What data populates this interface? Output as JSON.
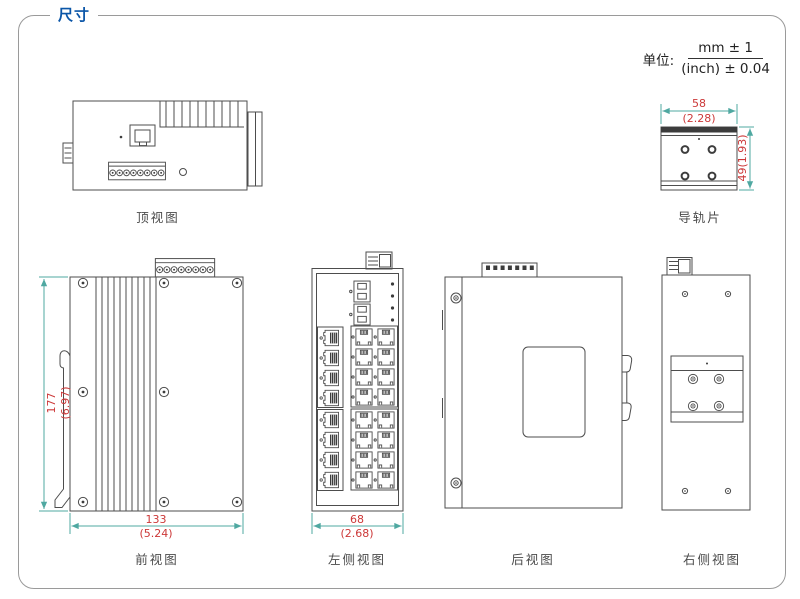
{
  "header": {
    "title": "尺寸"
  },
  "unit": {
    "label": "单位:",
    "numerator": "mm ± 1",
    "denominator": "(inch) ± 0.04"
  },
  "views": {
    "top": {
      "label": "顶视图"
    },
    "rail": {
      "label": "导轨片",
      "width_mm": "58",
      "width_inch": "(2.28)",
      "height_dim": "49(1.93)"
    },
    "front": {
      "label": "前视图",
      "height_mm": "177",
      "height_inch": "(6.97)",
      "width_mm": "133",
      "width_inch": "(5.24)"
    },
    "left": {
      "label": "左侧视图",
      "width_mm": "68",
      "width_inch": "(2.68)"
    },
    "rear": {
      "label": "后视图"
    },
    "right": {
      "label": "右侧视图"
    }
  },
  "colors": {
    "accent_blue": "#0b56a8",
    "dimension_text_red": "#cc3838",
    "dimension_line_teal": "#4fa8a1",
    "drawing_line_gray": "#4d4d4d",
    "frame_border_gray": "#9a9a9a"
  }
}
